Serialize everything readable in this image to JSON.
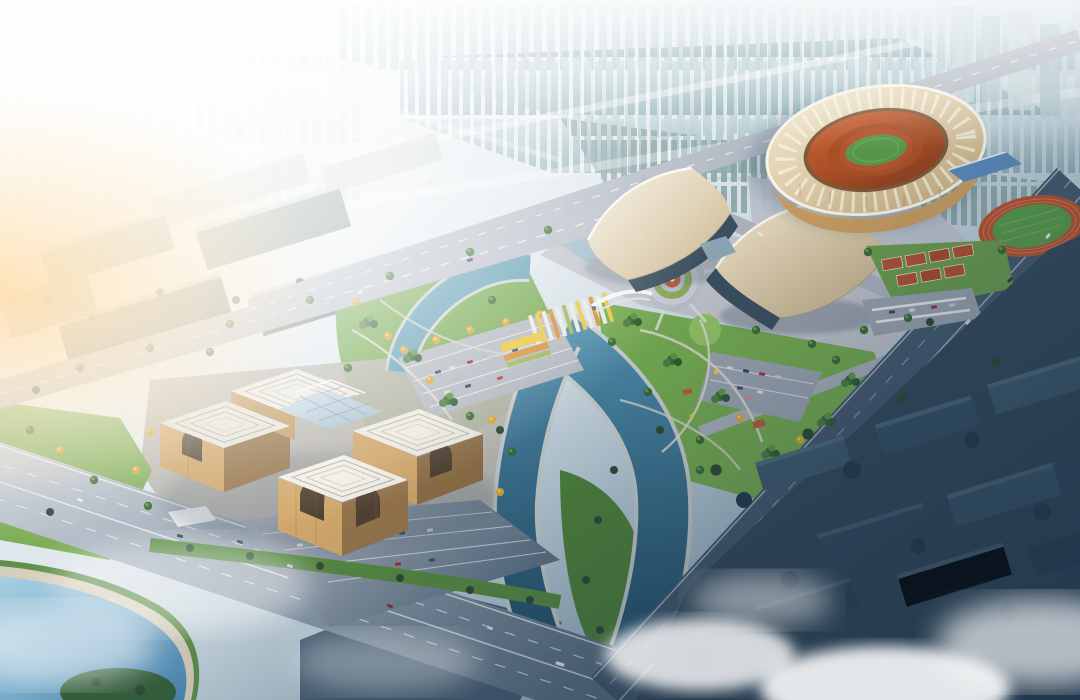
{
  "scene": {
    "type": "aerial-architectural-rendering",
    "elements": [
      "city-skyline",
      "office-district",
      "stadium",
      "practice-track",
      "convention-hall-west",
      "convention-hall-east",
      "cultural-center",
      "fountain-plaza",
      "flower-parterre",
      "gateway-sculpture",
      "central-park",
      "canal",
      "reflecting-pool",
      "lake",
      "parking-lots",
      "tennis-courts",
      "residential-district",
      "highways",
      "mist-clouds",
      "sun-glare"
    ]
  },
  "colors": {
    "haze_white": "#fbfcfd",
    "sky_steel": "#7d9aac",
    "tower_light": "#d8e8ea",
    "tower_mid": "#9fbcc2",
    "tower_teal_light": "#bcd3d6",
    "tower_teal": "#84a6ac",
    "tower_near": "#7e9a99",
    "office_green": "#6d7f74",
    "office_light": "#8a9a8e",
    "road_light": "#b6bcc6",
    "road_mid": "#9aa3b0",
    "road_dark": "#44596d",
    "pavement": "#bcc1ca",
    "plaza_dark": "#4a6074",
    "lawn": "#74a94e",
    "lawn_bright": "#8fbf63",
    "lawn_dark": "#4e8138",
    "tree": "#3a6a34",
    "tree_dark": "#2c4a33",
    "tree_autumn": "#d8a43c",
    "water_light": "#5f9cb4",
    "water": "#4c8aa8",
    "water_deep": "#1f4760",
    "lake": "#4c88b2",
    "pool": "#9fb9c6",
    "roof_cream_light": "#f4eedd",
    "roof_cream": "#cbb68f",
    "roof_white": "#ece9e1",
    "roof_line": "#b5b0a2",
    "glass": "#b7ccd8",
    "glass_dark": "#3c4f5f",
    "facade_tan": "#cfa468",
    "facade_shade": "#96744a",
    "stadium_cream": "#f2ead2",
    "stadium_gold": "#c79b5e",
    "seats_orange": "#cb6233",
    "field_green": "#58984a",
    "track_red": "#b5522f",
    "court_red": "#b0502f",
    "roof_blue": "#5b87b8",
    "flower_yellow": "#e8c63f",
    "flower_orange": "#d98f2e",
    "stripe_white": "#eceadf",
    "mist": "#ffffff",
    "dusk": "#16304a",
    "sun": "#ffe0b2"
  }
}
